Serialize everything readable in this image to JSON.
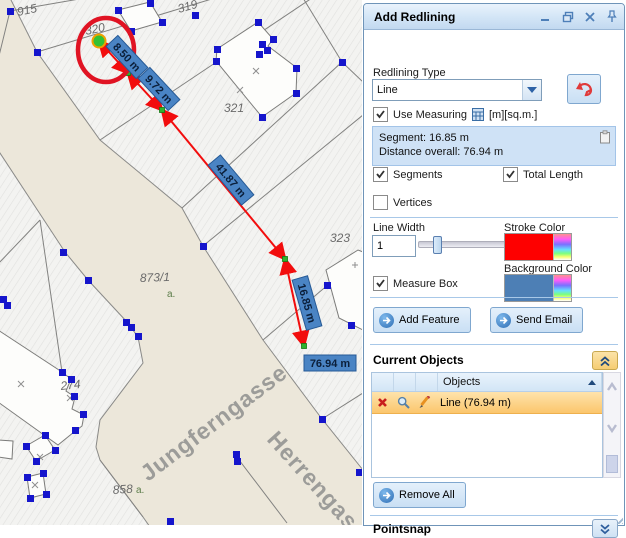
{
  "window": {
    "title": "Add Redlining",
    "controls": {
      "minimize": "minimize",
      "restore": "restore",
      "close": "close",
      "pin": "pin"
    }
  },
  "form": {
    "redlining_type_label": "Redlining Type",
    "redlining_type_value": "Line",
    "use_measuring_label": "Use Measuring",
    "use_measuring_units": "[m][sq.m.]",
    "use_measuring_checked": true,
    "measure_summary": {
      "segment_line": "Segment: 16.85 m",
      "overall_line": "Distance overall: 76.94 m"
    },
    "segments": {
      "label": "Segments",
      "checked": true
    },
    "total_length": {
      "label": "Total Length",
      "checked": true
    },
    "vertices": {
      "label": "Vertices",
      "checked": false
    },
    "line_width": {
      "label": "Line Width",
      "value": "1"
    },
    "stroke_color": {
      "label": "Stroke Color",
      "value": "#ff0000"
    },
    "measure_box": {
      "label": "Measure Box",
      "checked": true
    },
    "background_color": {
      "label": "Background Color",
      "value": "#4d7fb5"
    },
    "add_feature_label": "Add Feature",
    "send_email_label": "Send Email"
  },
  "current_objects": {
    "title": "Current Objects",
    "columns": {
      "objects": "Objects"
    },
    "rows": [
      {
        "object_label": "Line (76.94 m)"
      }
    ],
    "remove_all_label": "Remove All"
  },
  "pointsnap": {
    "title": "Pointsnap"
  },
  "map": {
    "parcels": [
      {
        "text": "915"
      },
      {
        "text": "320"
      },
      {
        "text": "319"
      },
      {
        "text": "321"
      },
      {
        "text": "323"
      },
      {
        "text": "873/1"
      },
      {
        "text": "274"
      },
      {
        "text": "858"
      }
    ],
    "streets": [
      {
        "text": "Jungferngasse"
      },
      {
        "text": "Herrengasse"
      }
    ],
    "measurements": [
      {
        "text": "8.50 m"
      },
      {
        "text": "9.72 m"
      },
      {
        "text": "41.87 m"
      },
      {
        "text": "16.85 m"
      },
      {
        "text": "76.94 m"
      }
    ],
    "small_marks": [
      {
        "text": "a."
      },
      {
        "text": "a."
      }
    ],
    "colors": {
      "measure_label_bg": "#4a84c4",
      "measure_line": "#f20d0d",
      "street_fill": "#ece7da",
      "vertex_blue": "#1515cc",
      "vertex_green": "#2fb32f",
      "highlight_circle": "#e01323"
    }
  }
}
